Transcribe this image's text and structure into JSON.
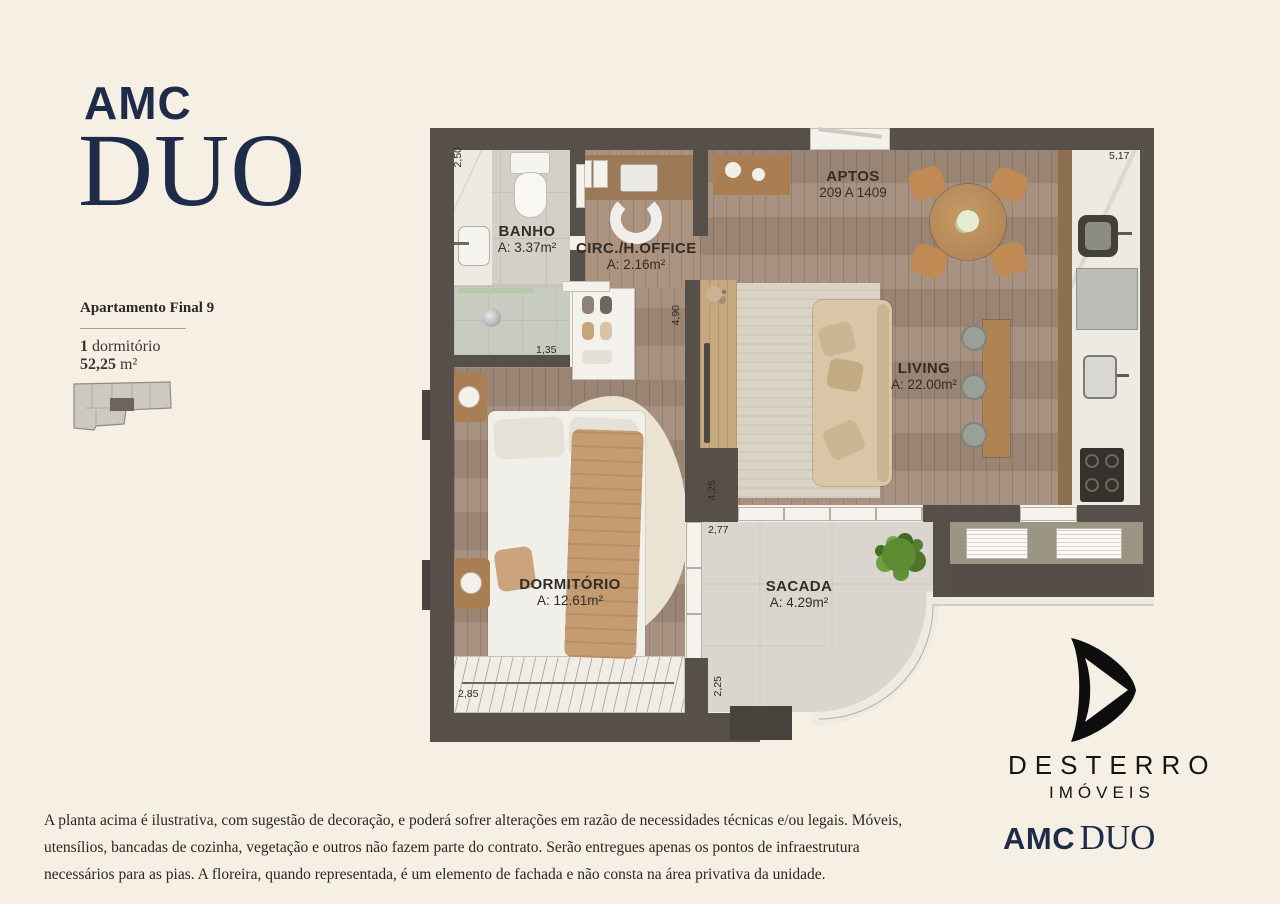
{
  "brand": {
    "amc": "AMC",
    "duo": "DUO"
  },
  "sidebar": {
    "title": "Apartamento Final 9",
    "bedrooms_num": "1",
    "bedrooms_label": " dormitório",
    "area_value": "52,25",
    "area_unit": " m²"
  },
  "plan": {
    "rooms": {
      "banho": {
        "name": "BANHO",
        "area": "A: 3.37m²"
      },
      "circ": {
        "name": "CIRC./H.OFFICE",
        "area": "A: 2.16m²"
      },
      "living": {
        "name": "LIVING",
        "area": "A: 22.00m²"
      },
      "dormitorio": {
        "name": "DORMITÓRIO",
        "area": "A: 12.61m²"
      },
      "sacada": {
        "name": "SACADA",
        "area": "A: 4.29m²"
      }
    },
    "aptos": {
      "title": "APTOS",
      "range": "209 A 1409"
    },
    "dims": {
      "left_wall": "2,50",
      "kitchen": "5,17",
      "shower": "1,35",
      "hall": "4,90",
      "living_side": "4,25",
      "sacada_top": "2,77",
      "bedroom_window": "2,85",
      "sacada_side": "2,25"
    }
  },
  "footer": {
    "realtor": "DESTERRO",
    "realtor_sub": "IMÓVEIS",
    "brand_amc": "AMC",
    "brand_duo": "DUO"
  },
  "disclaimer": "A planta acima é ilustrativa, com sugestão de decoração, e poderá sofrer alterações em razão de necessidades técnicas e/ou legais. Móveis, utensílios, bancadas de cozinha, vegetação e outros não fazem parte do contrato. Serão entregues apenas os pontos de infraestrutura necessários para as pias. A floreira, quando representada, é um elemento de fachada e não consta na área privativa da unidade.",
  "colors": {
    "navy": "#1e2c4a",
    "cream": "#f6efe4",
    "wall": "#57504a",
    "ink": "#151515"
  }
}
